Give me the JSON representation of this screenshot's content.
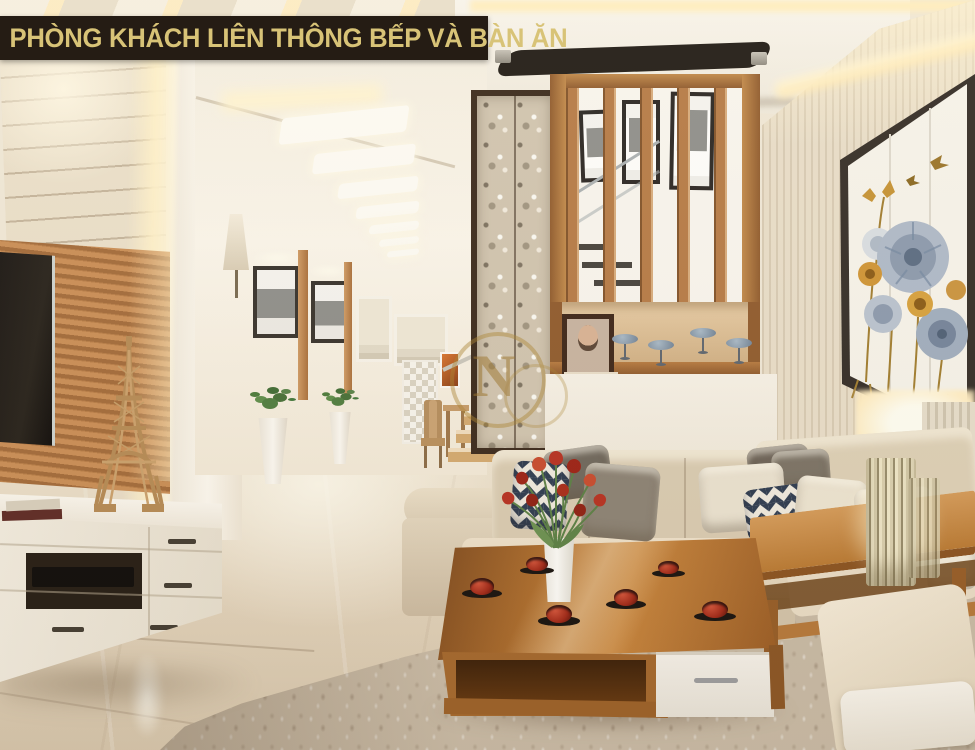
{
  "banner": {
    "title": "PHÒNG KHÁCH LIÊN THÔNG BẾP VÀ BÀN ĂN",
    "background_color": "#251c14",
    "text_color": "#d8c377"
  },
  "watermark": {
    "letter": "N",
    "color": "#a5782d"
  },
  "scene_colors": {
    "wood_accent": "#b5793f",
    "sofa_beige": "#ddd0b8",
    "wall_cream": "#ece3d1",
    "floor_marble": "#d9c9b1",
    "cove_glow": "#ffeec2",
    "tulip_red": "#c03420",
    "chevron_navy": "#2d3b50",
    "artwork_blue": "#8b99ad",
    "artwork_gold": "#cf9434"
  }
}
